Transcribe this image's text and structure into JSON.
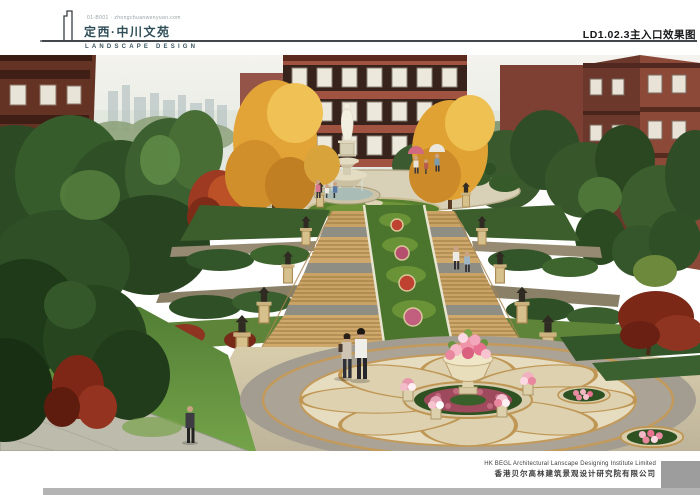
{
  "header": {
    "micro_text": "01-B001 · zhongchuanwenyuan.com",
    "title": "定西·中川文苑",
    "subtitle": "LANDSCAPE DESIGN",
    "sheet_label": "LD1.02.3主入口效果图"
  },
  "footer": {
    "company_en": "HK BEGL Architectural Lanscape Designing Institute Limited",
    "company_cn": "香港贝尔高林建筑景观设计研究院有限公司"
  },
  "image": {
    "alt": "Main entrance perspective rendering: grand staircase with terraced flower beds rising from a circular mosaic plaza with a stone flower urn to a classical statue fountain, flanked by autumn trees and red-brick residential buildings"
  },
  "colors": {
    "accent_teal": "#2f4e58",
    "rule_dark": "#43474b",
    "footer_block_gray": "#9d9d9d",
    "footer_bar_gray": "#b4b4b4"
  }
}
